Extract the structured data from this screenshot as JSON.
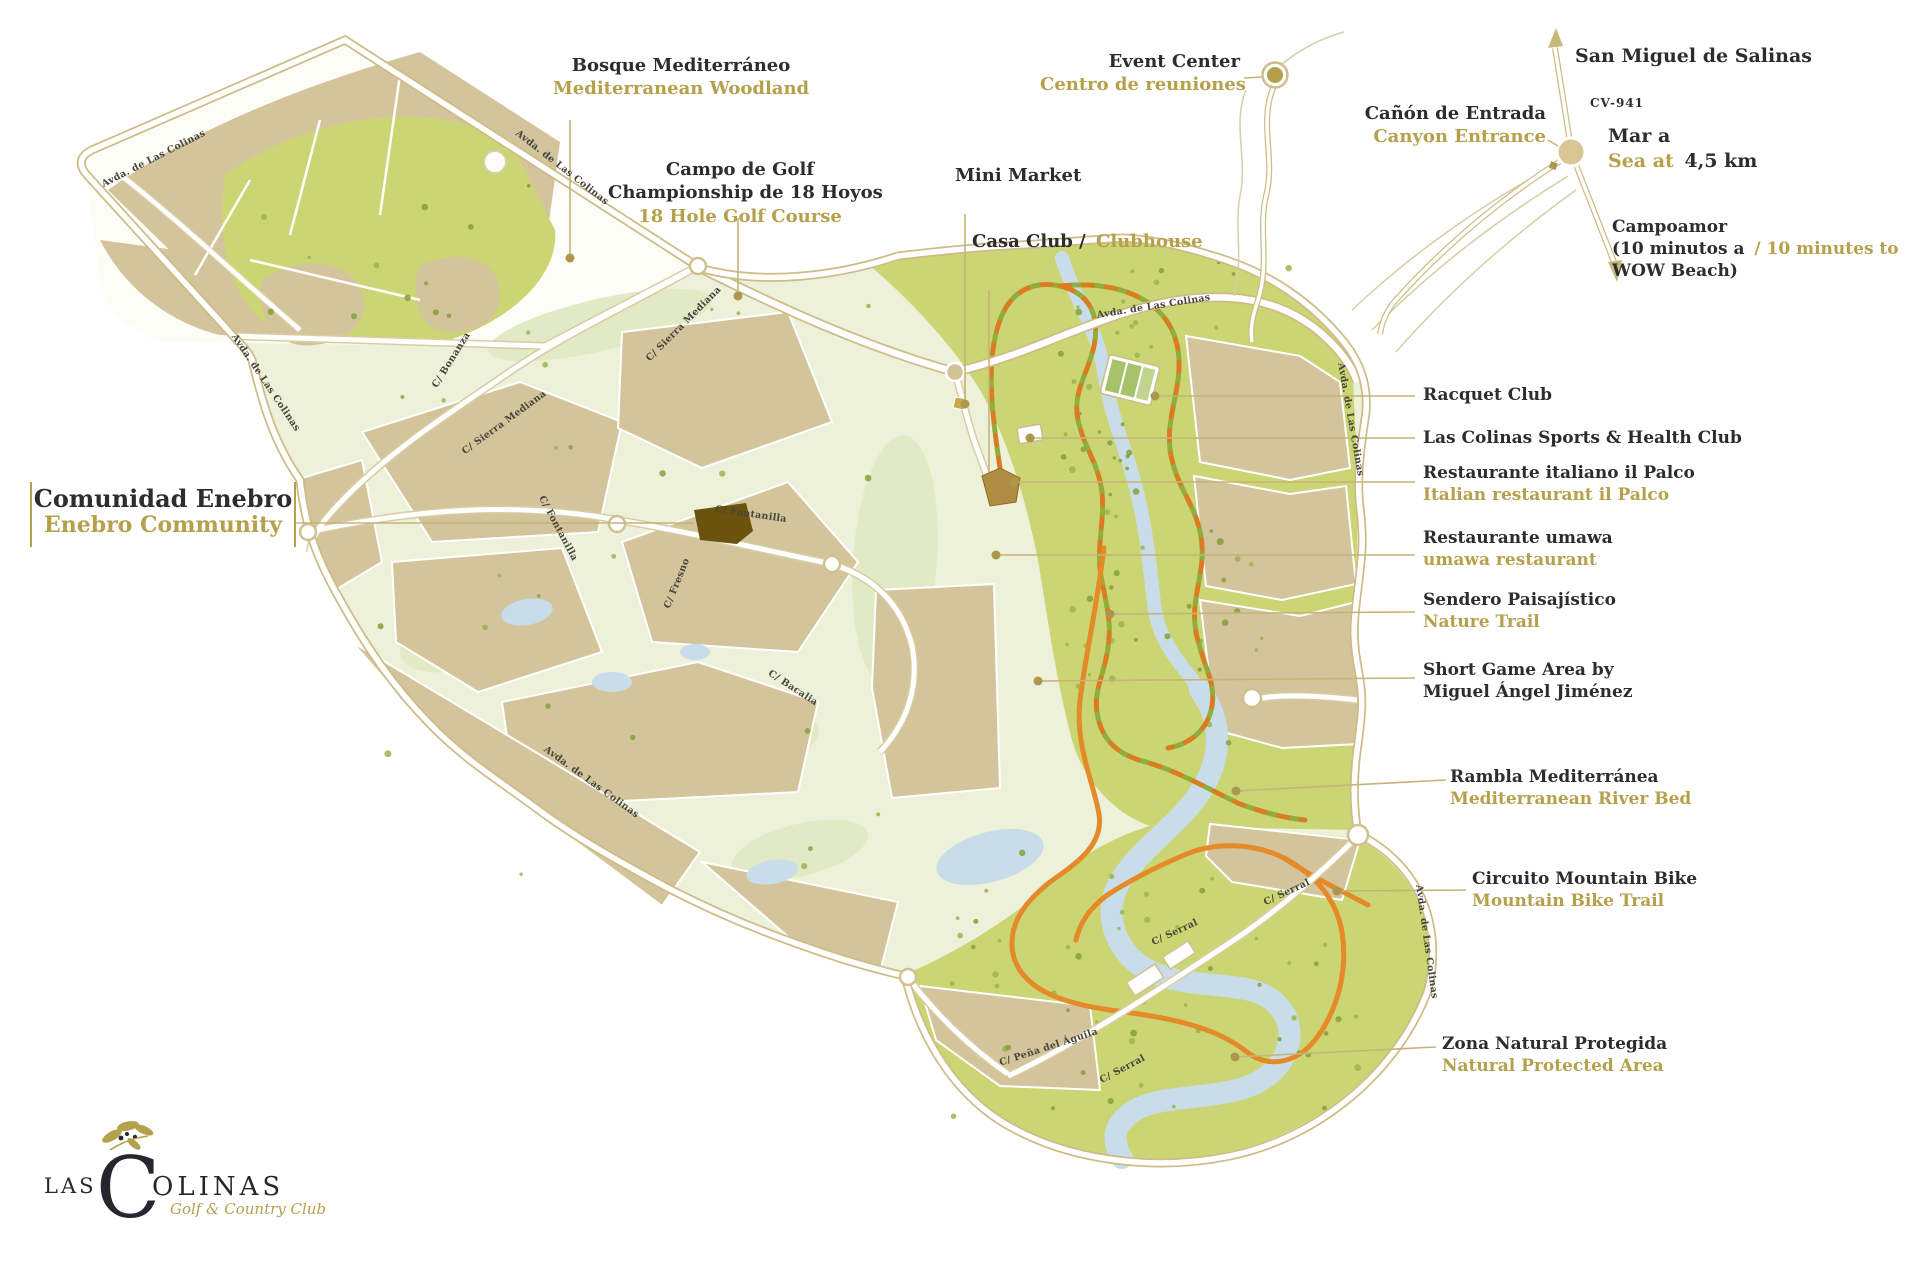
{
  "labels": {
    "bosque": {
      "title": "Bosque Mediterráneo",
      "subtitle": "Mediterranean Woodland"
    },
    "campo": {
      "line1": "Campo de Golf",
      "line2": "Championship de 18 Hoyos",
      "subtitle": "18 Hole Golf Course"
    },
    "mini_market": {
      "title": "Mini Market"
    },
    "casa_club": {
      "title": "Casa Club /",
      "subtitle": "Clubhouse"
    },
    "event_center": {
      "title": "Event Center",
      "subtitle": "Centro de reuniones"
    },
    "canyon": {
      "title": "Cañón de Entrada",
      "subtitle": "Canyon Entrance"
    },
    "san_miguel": {
      "title": "San Miguel de Salinas"
    },
    "road_code": {
      "title": "CV-941"
    },
    "sea": {
      "title_es": "Mar a",
      "subtitle_en": "Sea at",
      "distance": "4,5 km"
    },
    "campoamor": {
      "title": "Campoamor",
      "line2_es": "(10 minutos a",
      "line2_en": "/ 10 minutes to",
      "line3": "WOW Beach)"
    },
    "racquet": {
      "title": "Racquet Club"
    },
    "sports": {
      "title": "Las Colinas Sports & Health Club"
    },
    "palco": {
      "title": "Restaurante italiano il Palco",
      "subtitle": "Italian restaurant il Palco"
    },
    "umawa": {
      "title": "Restaurante umawa",
      "subtitle": "umawa restaurant"
    },
    "sendero": {
      "title": "Sendero Paisajístico",
      "subtitle": "Nature Trail"
    },
    "short_game": {
      "line1": "Short Game Area by",
      "line2": "Miguel Ángel Jiménez"
    },
    "rambla": {
      "title": "Rambla Mediterránea",
      "subtitle": "Mediterranean River Bed"
    },
    "mtb": {
      "title": "Circuito Mountain Bike",
      "subtitle": "Mountain Bike Trail"
    },
    "zona": {
      "title": "Zona Natural Protegida",
      "subtitle": "Natural Protected Area"
    },
    "enebro": {
      "title": "Comunidad Enebro",
      "subtitle": "Enebro Community"
    }
  },
  "streets": {
    "avda": "Avda. de Las Colinas",
    "sierra": "C/ Sierra Mediana",
    "bonanza": "C/ Bonanza",
    "fontanilla": "C/ Fontanilla",
    "fresno": "C/ Fresno",
    "bacalia": "C/ Bacalia",
    "serral": "C/ Serral",
    "pena": "C/ Peña del Águila"
  },
  "logo": {
    "word_start": "LAS",
    "initial": "C",
    "word_end": "OLINAS",
    "tagline": "Golf & Country Club"
  },
  "colors": {
    "gold_text": "#b5a04b",
    "dark_text": "#2e2d2b",
    "woodland_green": "#ccd573",
    "parcel_tan": "#d3c49b",
    "river_blue": "#c8dde9",
    "trail_green": "#8fae3b",
    "trail_orange": "#e0791f",
    "mtb_orange": "#e58a28",
    "road_casing": "#cdbc86"
  }
}
